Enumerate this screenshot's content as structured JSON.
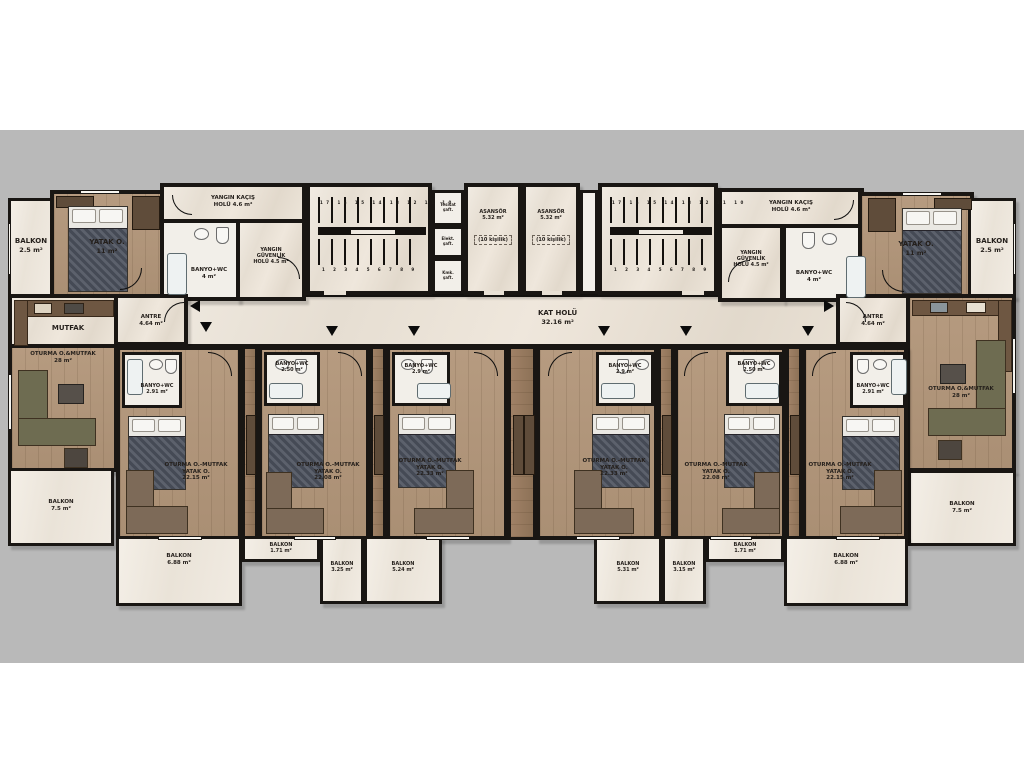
{
  "page": {
    "band_color": "#b9b9b9"
  },
  "core": {
    "asansor1": {
      "name": "ASANSÖR",
      "area": "5.32 m²",
      "capacity": "(10 kişilik)"
    },
    "asansor2": {
      "name": "ASANSÖR",
      "area": "5.32 m²",
      "capacity": "(10 kişilik)"
    },
    "kat_holu": {
      "name": "KAT HOLÜ",
      "area": "32.16 m²"
    },
    "stair_numbers_upper": "17 16 15 14 13 12 11 10",
    "stair_numbers_lower": "1 2 3 4 5 6 7 8 9",
    "shafts": [
      {
        "l1": "Tesisat",
        "l2": "şaft."
      },
      {
        "l1": "Elekt.",
        "l2": "şaft."
      },
      {
        "l1": "Kmk.",
        "l2": "şaft."
      }
    ]
  },
  "left_wing": {
    "balkon_top": {
      "name": "BALKON",
      "area": "2.5 m²"
    },
    "yatak": {
      "name": "YATAK O.",
      "area": "11 m²"
    },
    "yangin_kacis": {
      "l1": "YANGIN KAÇIŞ",
      "l2": "HOLÜ  4.6 m²"
    },
    "yangin_guvenlik": {
      "l1": "YANGIN",
      "l2": "GÜVENLİK",
      "l3": "HOLÜ  4.5 m²"
    },
    "banyo": {
      "name": "BANYO+WC",
      "area": "4 m²"
    },
    "antre": {
      "name": "ANTRE",
      "area": "4.64 m²"
    },
    "mutfak": {
      "name": "MUTFAK"
    },
    "oturma": {
      "name": "OTURMA O.&MUTFAK",
      "area": "28 m²"
    },
    "balkon_alt": {
      "name": "BALKON",
      "area": "7.5 m²"
    }
  },
  "right_wing": {
    "balkon_top": {
      "name": "BALKON",
      "area": "2.5 m²"
    },
    "yatak": {
      "name": "YATAK O.",
      "area": "11 m²"
    },
    "yangin_kacis": {
      "l1": "YANGIN KAÇIŞ",
      "l2": "HOLÜ  4.6 m²"
    },
    "yangin_guvenlik": {
      "l1": "YANGIN",
      "l2": "GÜVENLİK",
      "l3": "HOLÜ  4.5 m²"
    },
    "banyo": {
      "name": "BANYO+WC",
      "area": "4 m²"
    },
    "antre": {
      "name": "ANTRE",
      "area": "4.64 m²"
    },
    "oturma": {
      "name": "OTURMA O.&MUTFAK",
      "area": "28 m²"
    },
    "balkon_alt": {
      "name": "BALKON",
      "area": "7.5 m²"
    }
  },
  "studios": [
    {
      "banyo_name": "BANYO+WC",
      "banyo_area": "2.91 m²",
      "l1": "OTURMA O.-MUTFAK",
      "l2": "YATAK O.",
      "area": "22.15 m²"
    },
    {
      "banyo_name": "BANYO+WC",
      "banyo_area": "2.50 m²",
      "l1": "OTURMA O.-MUTFAK",
      "l2": "YATAK O.",
      "area": "22.08 m²"
    },
    {
      "banyo_name": "BANYO+WC",
      "banyo_area": "2.9 m²",
      "l1": "OTURMA O.-MUTFAK",
      "l2": "YATAK O.",
      "area": "22.33 m²"
    },
    {
      "banyo_name": "BANYO+WC",
      "banyo_area": "2.9 m²",
      "l1": "OTURMA O.-MUTFAK",
      "l2": "YATAK O.",
      "area": "22.33 m²"
    },
    {
      "banyo_name": "BANYO+WC",
      "banyo_area": "2.50 m²",
      "l1": "OTURMA O.-MUTFAK",
      "l2": "YATAK O.",
      "area": "22.08 m²"
    },
    {
      "banyo_name": "BANYO+WC",
      "banyo_area": "2.91 m²",
      "l1": "OTURMA O.-MUTFAK",
      "l2": "YATAK O.",
      "area": "22.15 m²"
    }
  ],
  "balconies": [
    {
      "name": "BALKON",
      "area": "6.88 m²"
    },
    {
      "name": "BALKON",
      "area": "1.71 m²"
    },
    {
      "name": "BALKON",
      "area": "3.25 m²"
    },
    {
      "name": "BALKON",
      "area": "5.24 m²"
    },
    {
      "name": "BALKON",
      "area": "5.31 m²"
    },
    {
      "name": "BALKON",
      "area": "3.15 m²"
    },
    {
      "name": "BALKON",
      "area": "1.71 m²"
    },
    {
      "name": "BALKON",
      "area": "6.88 m²"
    }
  ]
}
